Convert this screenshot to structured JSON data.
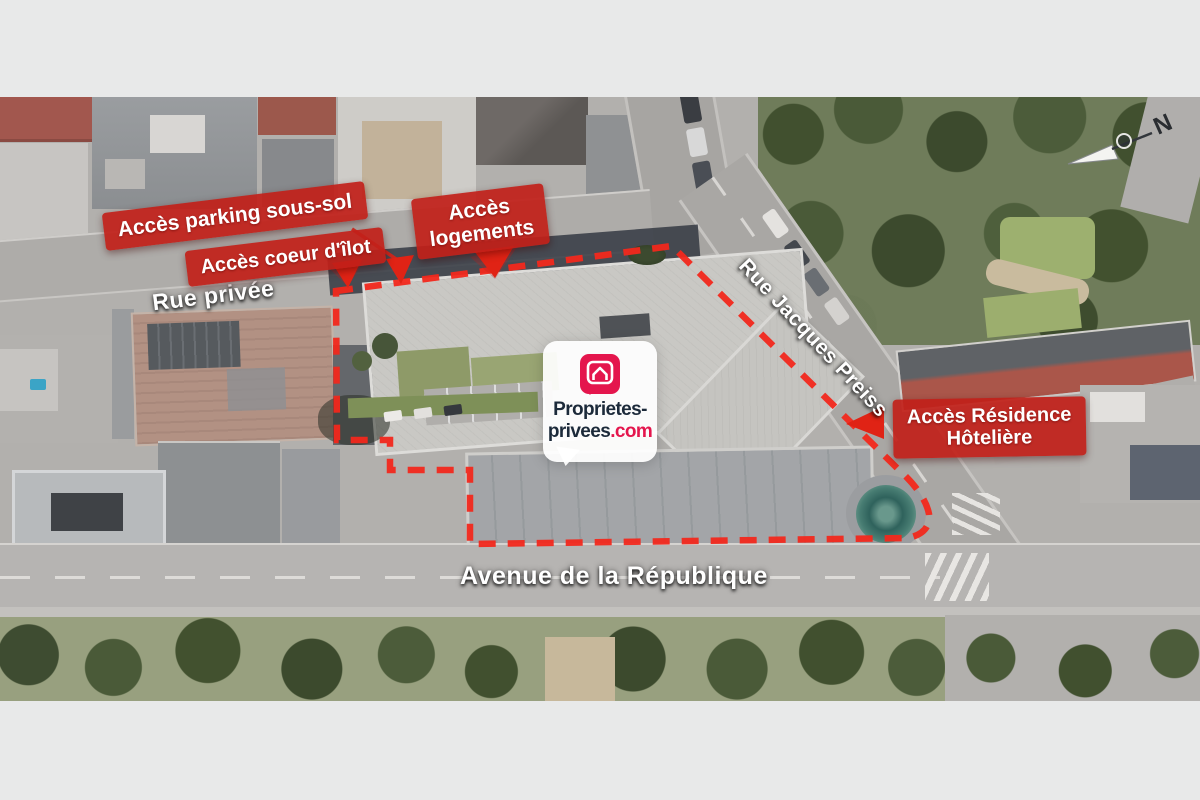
{
  "labels": {
    "parking": "Accès parking sous-sol",
    "coeur": "Accès coeur d'îlot",
    "logements_line1": "Accès",
    "logements_line2": "logements",
    "residence_line1": "Accès Résidence",
    "residence_line2": "Hôtelière"
  },
  "streets": {
    "rue_privee": "Rue privée",
    "rue_jacques_preiss": "Rue Jacques Preiss",
    "avenue_republique": "Avenue de la République"
  },
  "logo": {
    "line1": "Proprietes-",
    "line2_dark": "privees",
    "line2_red": ".com"
  },
  "compass": {
    "north": "N"
  },
  "colors": {
    "label_red": "#c12019",
    "boundary_red": "#f2281c",
    "logo_red": "#e4164d",
    "logo_navy": "#1c2a3a",
    "page_background": "#e8e9e9"
  }
}
